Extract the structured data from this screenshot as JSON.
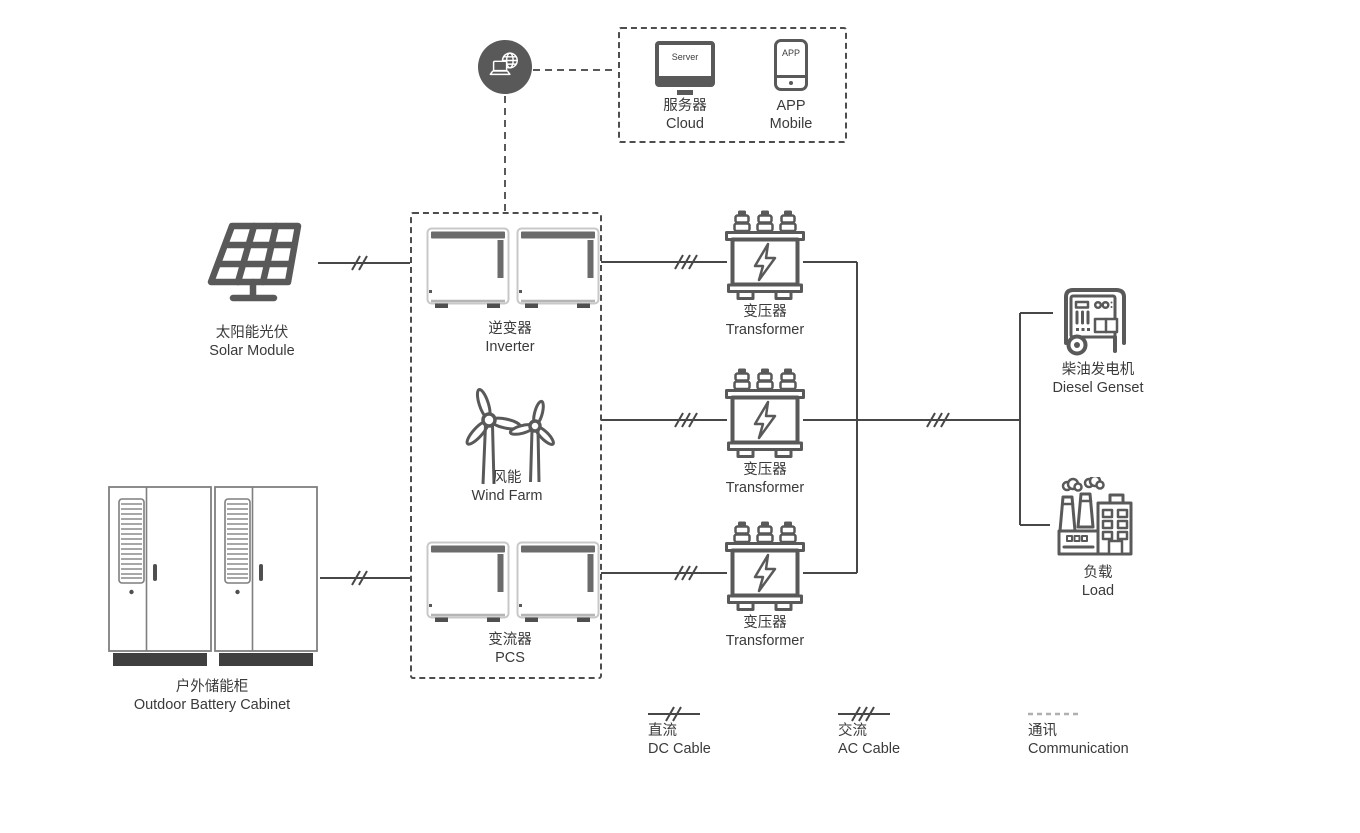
{
  "palette": {
    "icon_gray": "#595959",
    "line_dark": "#474747",
    "text": "#3a3a3a",
    "comm_legend_gray": "#b0b0b0"
  },
  "nodes": {
    "server": {
      "icon_text": "Server",
      "label_zh": "服务器",
      "label_en": "Cloud"
    },
    "app": {
      "icon_text": "APP",
      "label_zh": "APP",
      "label_en": "Mobile"
    },
    "solar": {
      "label_zh": "太阳能光伏",
      "label_en": "Solar Module"
    },
    "inverter": {
      "label_zh": "逆变器",
      "label_en": "Inverter"
    },
    "wind": {
      "label_zh": "风能",
      "label_en": "Wind Farm"
    },
    "pcs": {
      "label_zh": "变流器",
      "label_en": "PCS"
    },
    "transformer": {
      "label_zh": "变压器",
      "label_en": "Transformer"
    },
    "diesel": {
      "label_zh": "柴油发电机",
      "label_en": "Diesel Genset"
    },
    "load": {
      "label_zh": "负载",
      "label_en": "Load"
    },
    "battery": {
      "label_zh": "户外储能柜",
      "label_en": "Outdoor Battery Cabinet"
    }
  },
  "legend": {
    "dc": {
      "label_zh": "直流",
      "label_en": "DC Cable"
    },
    "ac": {
      "label_zh": "交流",
      "label_en": "AC Cable"
    },
    "comm": {
      "label_zh": "通讯",
      "label_en": "Communication"
    }
  }
}
